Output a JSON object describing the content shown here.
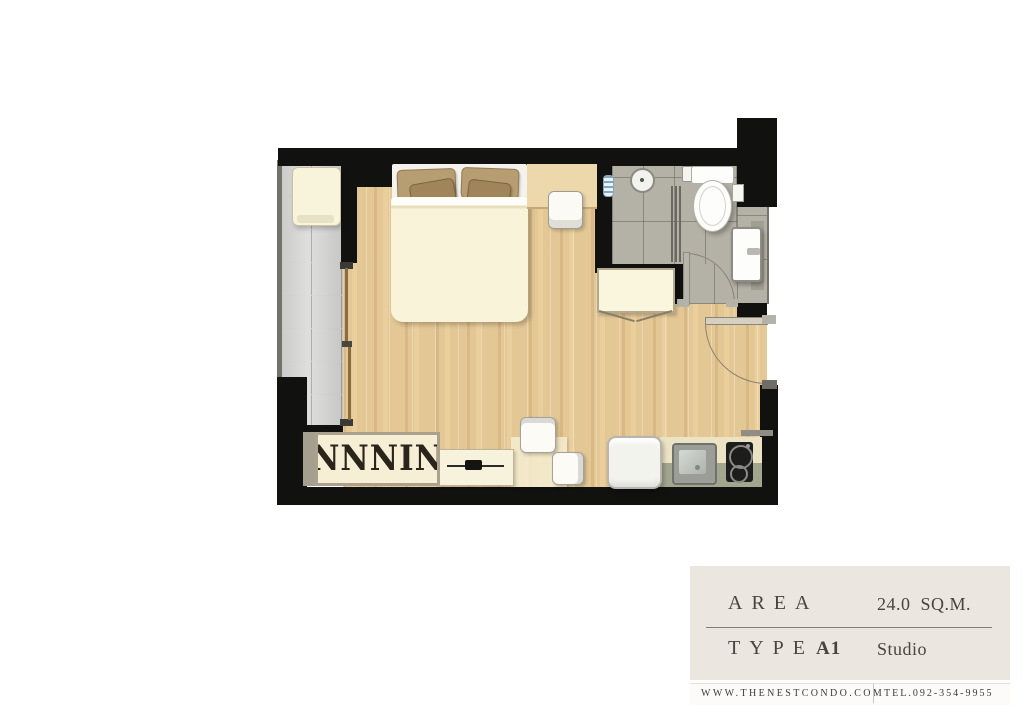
{
  "info_panel": {
    "area_label": "AREA",
    "area_value": "24.0 SQ.M.",
    "type_label": "TYPE",
    "type_code": "A1",
    "type_value": "Studio"
  },
  "footer": {
    "website": "WWW.THENESTCONDO.COM",
    "phone": "TEL.092-354-9955"
  },
  "plan": {
    "unit": {
      "area_sqm": 24.0,
      "type": "A1",
      "layout": "Studio"
    },
    "rooms": [
      "balcony",
      "sleeping-living-area",
      "bathroom",
      "kitchenette",
      "entrance"
    ],
    "furniture": [
      "washing-machine",
      "double-bed",
      "vanity-counter",
      "vanity-chair",
      "wardrobe",
      "tv-console",
      "desk",
      "chairs",
      "refrigerator",
      "kitchen-counter",
      "kitchen-sink",
      "hob",
      "shower",
      "toilet",
      "wash-basin",
      "storage-cabinet"
    ],
    "wardrobe_glyphs": "NNNNINN",
    "colors": {
      "wall": "#111110",
      "wood_floor": "#e3c795",
      "balcony_tile": "#dadad8",
      "bath_tile": "#b4b2a6",
      "panel_bg": "#ebe7e0"
    }
  }
}
